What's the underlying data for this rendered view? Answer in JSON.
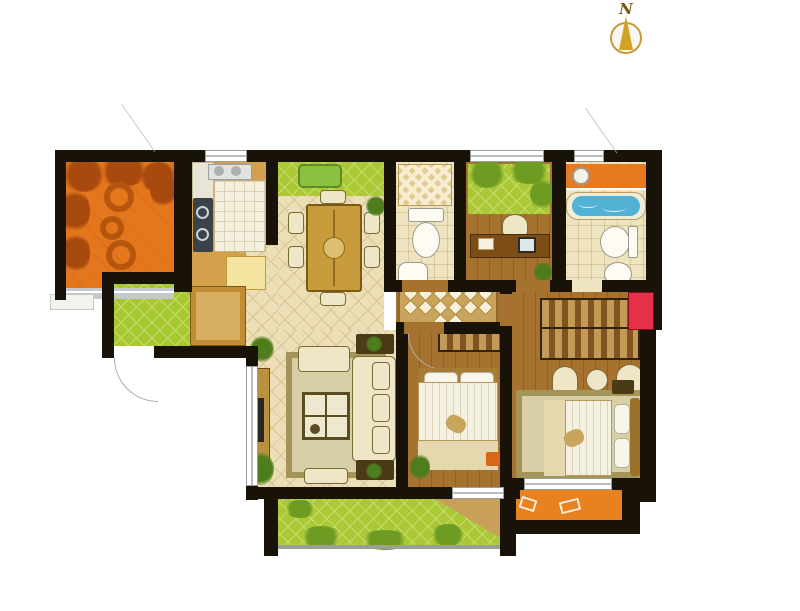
{
  "compass": {
    "label": "N"
  },
  "palette": {
    "wall": "#191208",
    "tile_floor": "#ecdeb6",
    "tile_line": "#d9c593",
    "wood_floor": "#a5722f",
    "lawn": "#abc937",
    "lawn_line": "#c6dd6b",
    "lawn_dark": "#6e9b22",
    "entry_tile": "#a8c832",
    "terrace_orange": "#e4771d",
    "terrace_leaf": "#a84a0e",
    "balcony_orange": "#e8821f",
    "bath_floor": "#efe4c0",
    "counter_white": "#f2efdf",
    "tub_blue": "#52b2d6",
    "vanity_orange": "#e7791f",
    "red_cabinet": "#e63048",
    "furniture_cream": "#efe6c8",
    "furniture_outline": "#7a6a34",
    "table_gold": "#c89b3c",
    "rug_border": "#a4945a",
    "rug_inner": "#d9cfa6",
    "runner_bg": "#c9a45c",
    "wardrobe_light": "#c49a58",
    "wardrobe_dark": "#845420",
    "bed_white": "#f5f1e1",
    "blanket_tan": "#e5d7ae",
    "headboard_tan": "#a87c34",
    "dark_furniture": "#4a3a16",
    "plant_green": "#4e7d1d",
    "railing_gray": "#c3c9cd"
  }
}
